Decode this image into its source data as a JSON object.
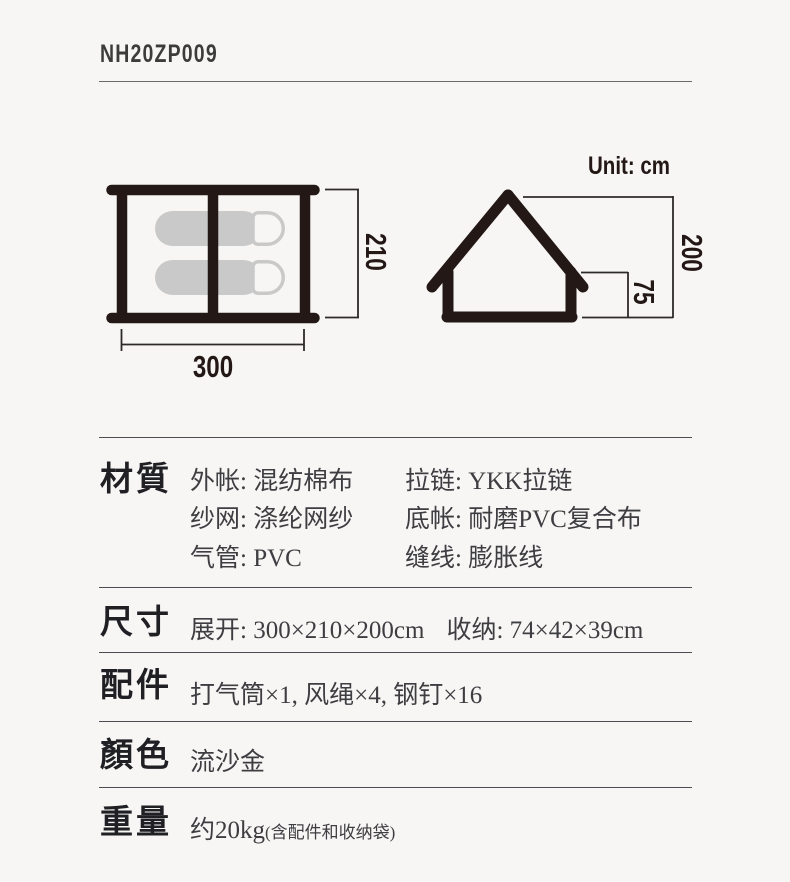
{
  "page": {
    "model_number": "NH20ZP009",
    "unit_label": "Unit: cm"
  },
  "diagram": {
    "top_view": {
      "width_label": "300",
      "depth_label": "210",
      "sleeping_pads": 2
    },
    "side_view": {
      "total_height_label": "200",
      "wall_height_label": "75"
    }
  },
  "specs": {
    "material": {
      "label": "材質",
      "col1": [
        "外帐: 混纺棉布",
        "纱网: 涤纶网纱",
        "气管: PVC"
      ],
      "col2": [
        "拉链: YKK拉链",
        "底帐: 耐磨PVC复合布",
        "缝线: 膨胀线"
      ]
    },
    "dimensions": {
      "label": "尺寸",
      "deployed": "展开: 300×210×200cm",
      "packed": "收纳: 74×42×39cm"
    },
    "accessories": {
      "label": "配件",
      "value": "打气筒×1, 风绳×4, 钢钉×16"
    },
    "color": {
      "label": "顏色",
      "value": "流沙金"
    },
    "weight": {
      "label": "重量",
      "value": "约20kg",
      "note": "(含配件和收纳袋)"
    }
  },
  "colors": {
    "ink": "#231815",
    "dimension_line": "#2e2a28",
    "body_text": "#3e3e42",
    "pad_gray": "#c9c9c9",
    "background": "#f7f6f4"
  }
}
